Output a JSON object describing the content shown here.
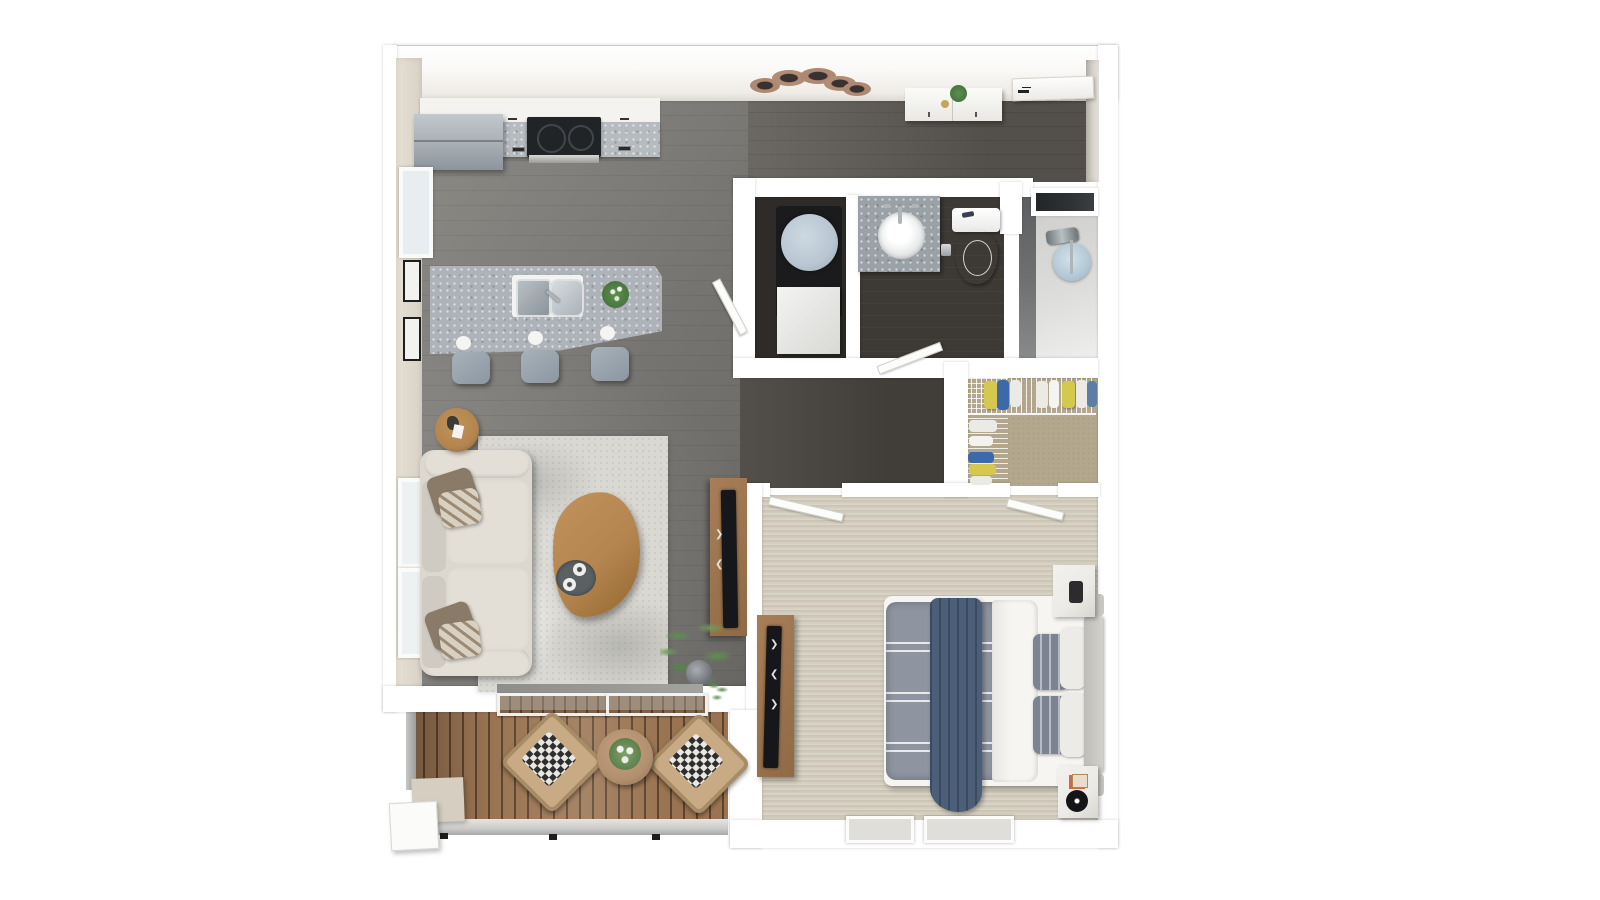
{
  "title": "3d-apartment-floor-plan",
  "palette": {
    "wall": "#ffffff",
    "wall-face": "#f4f1ec",
    "wall-beige": "#d9d2c5",
    "floor-light": "#8d8b86",
    "floor-mid": "#767471",
    "floor-dark": "#534f4a",
    "hallway-dark": "#413d39",
    "bath-floor": "#3d3935",
    "laundry-floor": "#2e2b28",
    "shower-floor": "#dcdcda",
    "closet-floor": "#b3a88e",
    "carpet-top": "#c9c2b1",
    "carpet-bottom": "#dcd7ca",
    "deck-wood": "#9a7452",
    "deck-gap": "#5a442f",
    "granite": "#b6bbc0",
    "island-granite": "#aeb3b9",
    "cabinet-white": "#f4f3f0",
    "fridge": "#a7aeb4",
    "stove-black": "#212427",
    "sofa": "#dcd8d0",
    "cushion": "#e3dfd7",
    "pillow-brown": "#8a7a68",
    "pillow-pattern": "#d8d0c0",
    "rug": "#d9d8d3",
    "rug-shade": "#b9b8b3",
    "wood-table": "#b5854f",
    "wood-console": "#a87e57",
    "tv-black": "#15171a",
    "plant-green": "#5e8f4f",
    "plant-dark": "#3f6b37",
    "bed-duvet": "#8e94a0",
    "bed-throw": "#4c5f78",
    "bed-sheet": "#f6f5f2",
    "bed-pillow": "#7c8494",
    "headboard": "#d3d1cc",
    "nightstand": "#ebeae6",
    "washer-top": "#b9c6d2",
    "washer-base": "#1b1b1d",
    "toilet-white": "#f6f6f4",
    "chrome": "#aeb6ba",
    "glass": "#6e7072",
    "niche-dark": "#2f3234",
    "clothes-yellow": "#d5c84e",
    "clothes-blue": "#3c6aa8",
    "clothes-white": "#eceae4",
    "wicker": "#c8ab84",
    "checker-dark": "#2e2e2e",
    "checker-light": "#e9e7e2",
    "railing": "#cbcbc9",
    "table-balcony": "#b29070",
    "step-beige": "#d5cec1"
  },
  "scene": {
    "type": "3d-top-down-floor-plan",
    "rooms": [
      {
        "name": "kitchen",
        "objects": [
          "refrigerator",
          "cooktop",
          "counter",
          "island",
          "double-sink",
          "bar-stools",
          "plant"
        ]
      },
      {
        "name": "entry",
        "objects": [
          "ceiling-fan",
          "console-table",
          "entry-door",
          "plant"
        ]
      },
      {
        "name": "living-room",
        "objects": [
          "sofa",
          "throw-pillows",
          "area-rug",
          "coffee-table",
          "tray-with-cups",
          "side-table",
          "tv-console",
          "tv",
          "floor-plant",
          "windows"
        ]
      },
      {
        "name": "laundry-closet",
        "objects": [
          "washer",
          "hamper",
          "door"
        ]
      },
      {
        "name": "bathroom",
        "objects": [
          "vanity",
          "round-sink",
          "faucet",
          "toilet",
          "door"
        ]
      },
      {
        "name": "shower",
        "objects": [
          "glass-door",
          "shower-valve",
          "shower-stool",
          "dark-niche"
        ]
      },
      {
        "name": "walk-in-closet",
        "objects": [
          "wire-shelving",
          "hanging-clothes"
        ]
      },
      {
        "name": "bedroom",
        "objects": [
          "bed",
          "gray-duvet",
          "blue-throw",
          "pillows",
          "headboard",
          "nightstand-with-lamp",
          "nightstand-with-speaker",
          "dresser",
          "tv",
          "doors",
          "floor-windows"
        ]
      },
      {
        "name": "balcony",
        "objects": [
          "wood-deck",
          "sliding-glass-door",
          "wicker-chair-left",
          "wicker-chair-right",
          "round-table",
          "plant",
          "railing",
          "step-box"
        ]
      }
    ]
  }
}
